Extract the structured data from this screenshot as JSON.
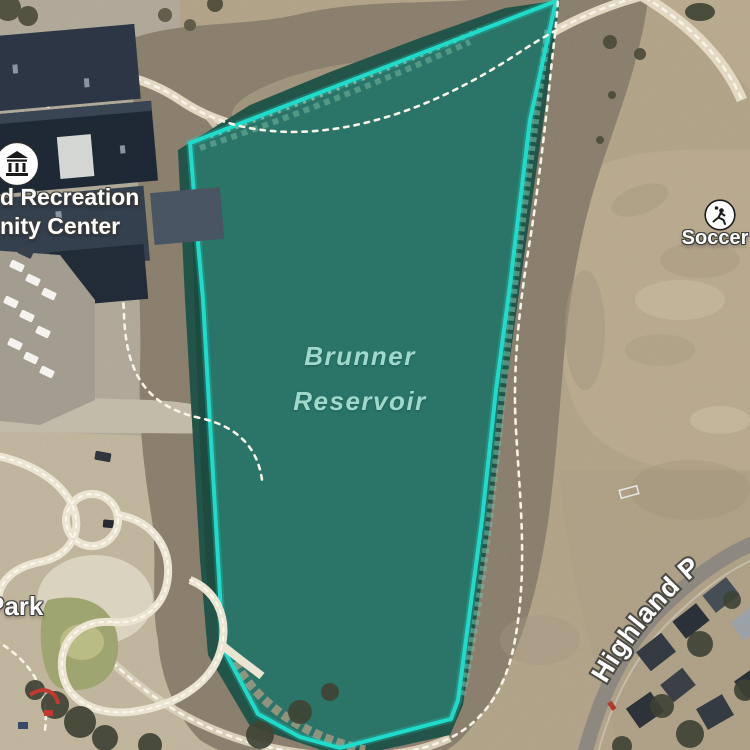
{
  "map": {
    "view": "satellite",
    "labels": {
      "reservoir": {
        "line1": "Brunner",
        "line2": "Reservoir"
      },
      "recreation_center": {
        "line1": "d Recreation",
        "line2": "nity Center"
      },
      "soccer": "Soccer",
      "park": "Park",
      "road": "Highland P"
    },
    "icons": {
      "recreation_center": "civic-building-icon",
      "soccer": "soccer-player-icon"
    },
    "colors": {
      "water": "#2a7568",
      "water_dark": "#235449",
      "outline": "#1fdcca",
      "label_water": "#9fd9cc",
      "ground": "#b3a58a",
      "field": "#bbac90",
      "scrub": "#8b7f6d",
      "trail": "#e3d9c2",
      "building": "#2c3644",
      "road": "#8e8980",
      "park_green": "#9fa571"
    }
  }
}
